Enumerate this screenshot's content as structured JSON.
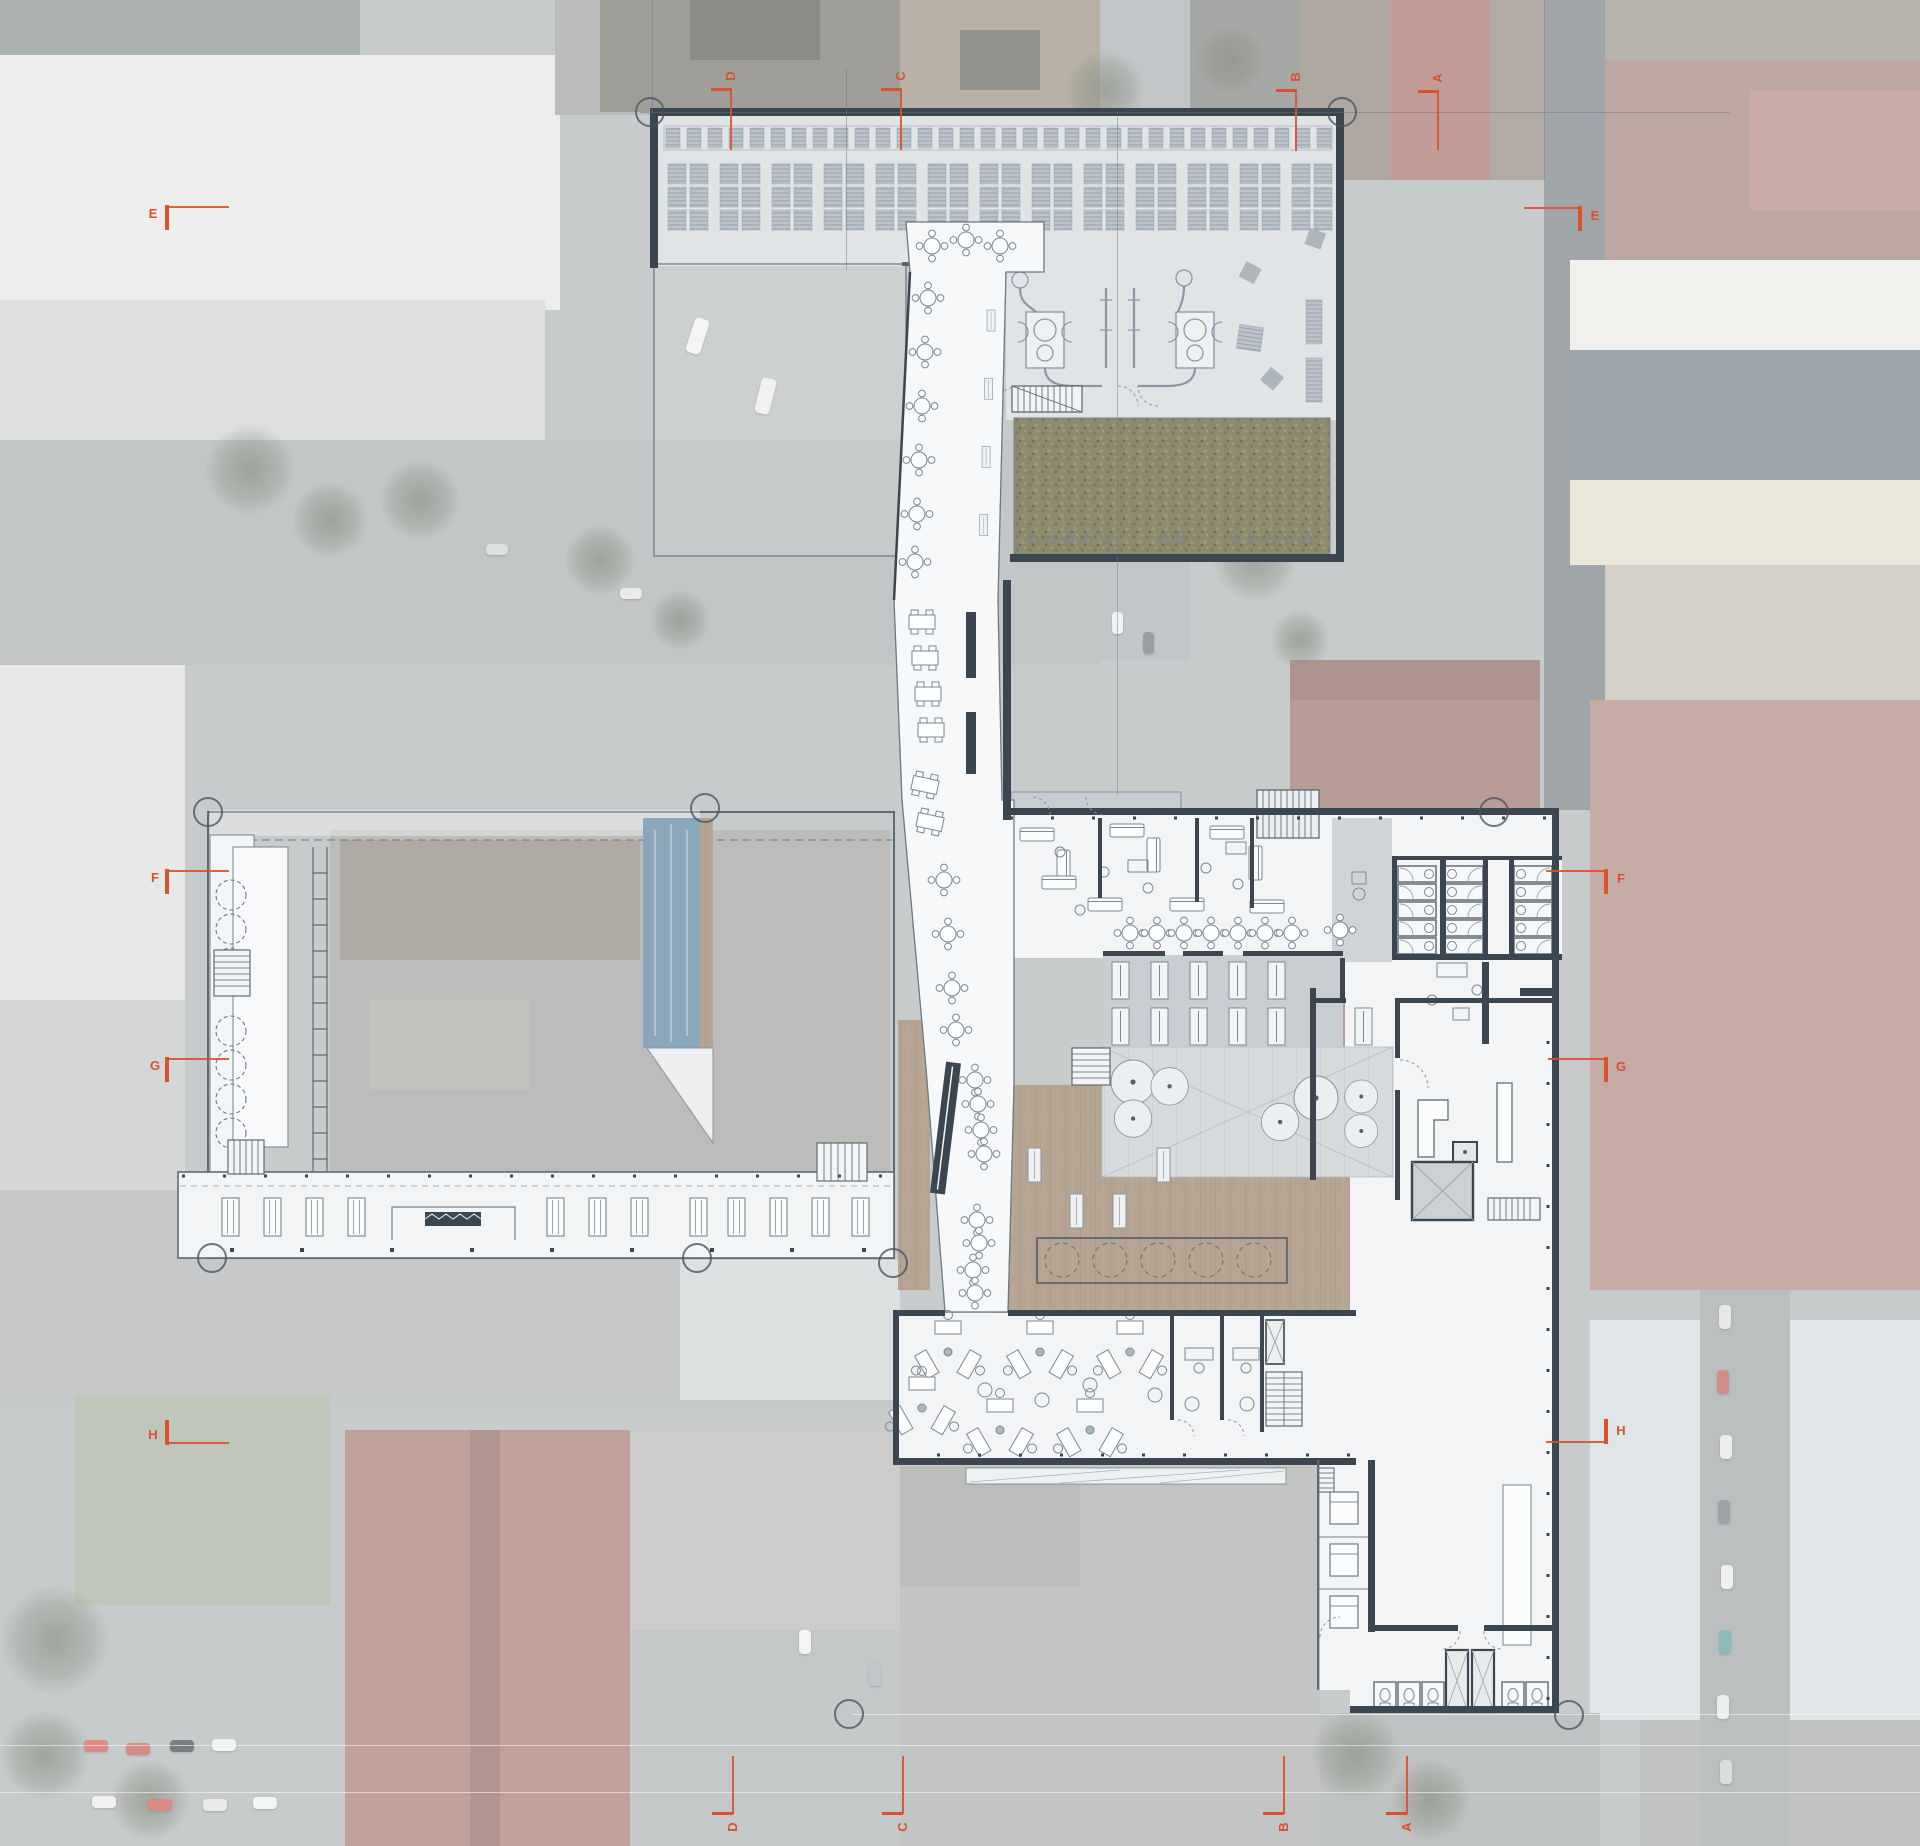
{
  "drawing": {
    "type": "architectural-site-plan",
    "description": "Ground floor plan overlaid on faded aerial photograph"
  },
  "colors": {
    "accent": "#d9512f",
    "wall": "#3b4650",
    "thin_line": "#76828d",
    "white_floor": "#f2f4f5",
    "hall_floor": "#e1e4e7",
    "gray_floor": "#c9ced3",
    "atrium_floor": "#d7dadd",
    "grass": "#8d8a6c",
    "wood": "#b5a492",
    "pool": "#8ba7bb",
    "photo_veil": "rgba(255,255,255,0.40)"
  },
  "section_markers": [
    {
      "label": "E",
      "bar": [
        165,
        205,
        4,
        25
      ],
      "line": [
        169,
        206,
        60,
        2
      ],
      "text": [
        144,
        206
      ],
      "rot": false
    },
    {
      "label": "F",
      "bar": [
        165,
        869,
        4,
        25
      ],
      "line": [
        169,
        870,
        60,
        2
      ],
      "text": [
        146,
        870
      ],
      "rot": false
    },
    {
      "label": "G",
      "bar": [
        165,
        1057,
        4,
        25
      ],
      "line": [
        169,
        1058,
        60,
        2
      ],
      "text": [
        146,
        1058
      ],
      "rot": false
    },
    {
      "label": "H",
      "bar": [
        165,
        1420,
        4,
        25
      ],
      "line": [
        169,
        1442,
        60,
        2
      ],
      "text": [
        144,
        1427
      ],
      "rot": false
    },
    {
      "label": "E",
      "bar": [
        1578,
        206,
        4,
        25
      ],
      "line": [
        1524,
        207,
        54,
        2
      ],
      "text": [
        1586,
        208
      ],
      "rot": false
    },
    {
      "label": "F",
      "bar": [
        1604,
        869,
        4,
        25
      ],
      "line": [
        1546,
        870,
        58,
        2
      ],
      "text": [
        1612,
        871
      ],
      "rot": false
    },
    {
      "label": "G",
      "bar": [
        1604,
        1057,
        4,
        25
      ],
      "line": [
        1548,
        1058,
        56,
        2
      ],
      "text": [
        1612,
        1059
      ],
      "rot": false
    },
    {
      "label": "H",
      "bar": [
        1604,
        1419,
        4,
        25
      ],
      "line": [
        1546,
        1441,
        58,
        2
      ],
      "text": [
        1612,
        1423
      ],
      "rot": false
    },
    {
      "label": "D",
      "bar": [
        711,
        88,
        21,
        3
      ],
      "line": [
        730,
        90,
        2,
        60
      ],
      "text": [
        722,
        68
      ],
      "rot": true
    },
    {
      "label": "C",
      "bar": [
        881,
        88,
        21,
        3
      ],
      "line": [
        900,
        90,
        2,
        60
      ],
      "text": [
        892,
        68
      ],
      "rot": true
    },
    {
      "label": "B",
      "bar": [
        1276,
        89,
        21,
        3
      ],
      "line": [
        1295,
        91,
        2,
        60
      ],
      "text": [
        1287,
        69
      ],
      "rot": true
    },
    {
      "label": "A",
      "bar": [
        1418,
        90,
        21,
        3
      ],
      "line": [
        1437,
        92,
        2,
        58
      ],
      "text": [
        1429,
        70
      ],
      "rot": true
    },
    {
      "label": "D",
      "bar": [
        712,
        1812,
        21,
        3
      ],
      "line": [
        732,
        1756,
        2,
        58
      ],
      "text": [
        724,
        1819
      ],
      "rot": true
    },
    {
      "label": "C",
      "bar": [
        882,
        1812,
        21,
        3
      ],
      "line": [
        902,
        1756,
        2,
        58
      ],
      "text": [
        894,
        1819
      ],
      "rot": true
    },
    {
      "label": "B",
      "bar": [
        1263,
        1812,
        21,
        3
      ],
      "line": [
        1283,
        1756,
        2,
        58
      ],
      "text": [
        1275,
        1819
      ],
      "rot": true
    },
    {
      "label": "A",
      "bar": [
        1386,
        1812,
        21,
        3
      ],
      "line": [
        1406,
        1756,
        2,
        58
      ],
      "text": [
        1398,
        1819
      ],
      "rot": true
    }
  ],
  "grid_bubbles": [
    [
      650,
      112
    ],
    [
      1342,
      112
    ],
    [
      705,
      808
    ],
    [
      1494,
      812
    ],
    [
      208,
      812
    ],
    [
      212,
      1258
    ],
    [
      697,
      1258
    ],
    [
      893,
      1263
    ],
    [
      849,
      1714
    ],
    [
      1569,
      1715
    ]
  ],
  "grid_lines": [
    {
      "o": "v",
      "x": 652,
      "y1": 0,
      "y2": 112
    },
    {
      "o": "v",
      "x": 846,
      "y1": 68,
      "y2": 270
    },
    {
      "o": "v",
      "x": 1117,
      "y1": 112,
      "y2": 795
    },
    {
      "o": "v",
      "x": 1544,
      "y1": 0,
      "y2": 808
    },
    {
      "o": "h",
      "y": 112,
      "x1": 640,
      "x2": 1730
    },
    {
      "o": "h",
      "y": 1714,
      "x1": 852,
      "x2": 1920
    },
    {
      "o": "h",
      "y": 1745,
      "x1": 0,
      "x2": 1920
    },
    {
      "o": "h",
      "y": 1792,
      "x1": 0,
      "x2": 1920
    }
  ]
}
